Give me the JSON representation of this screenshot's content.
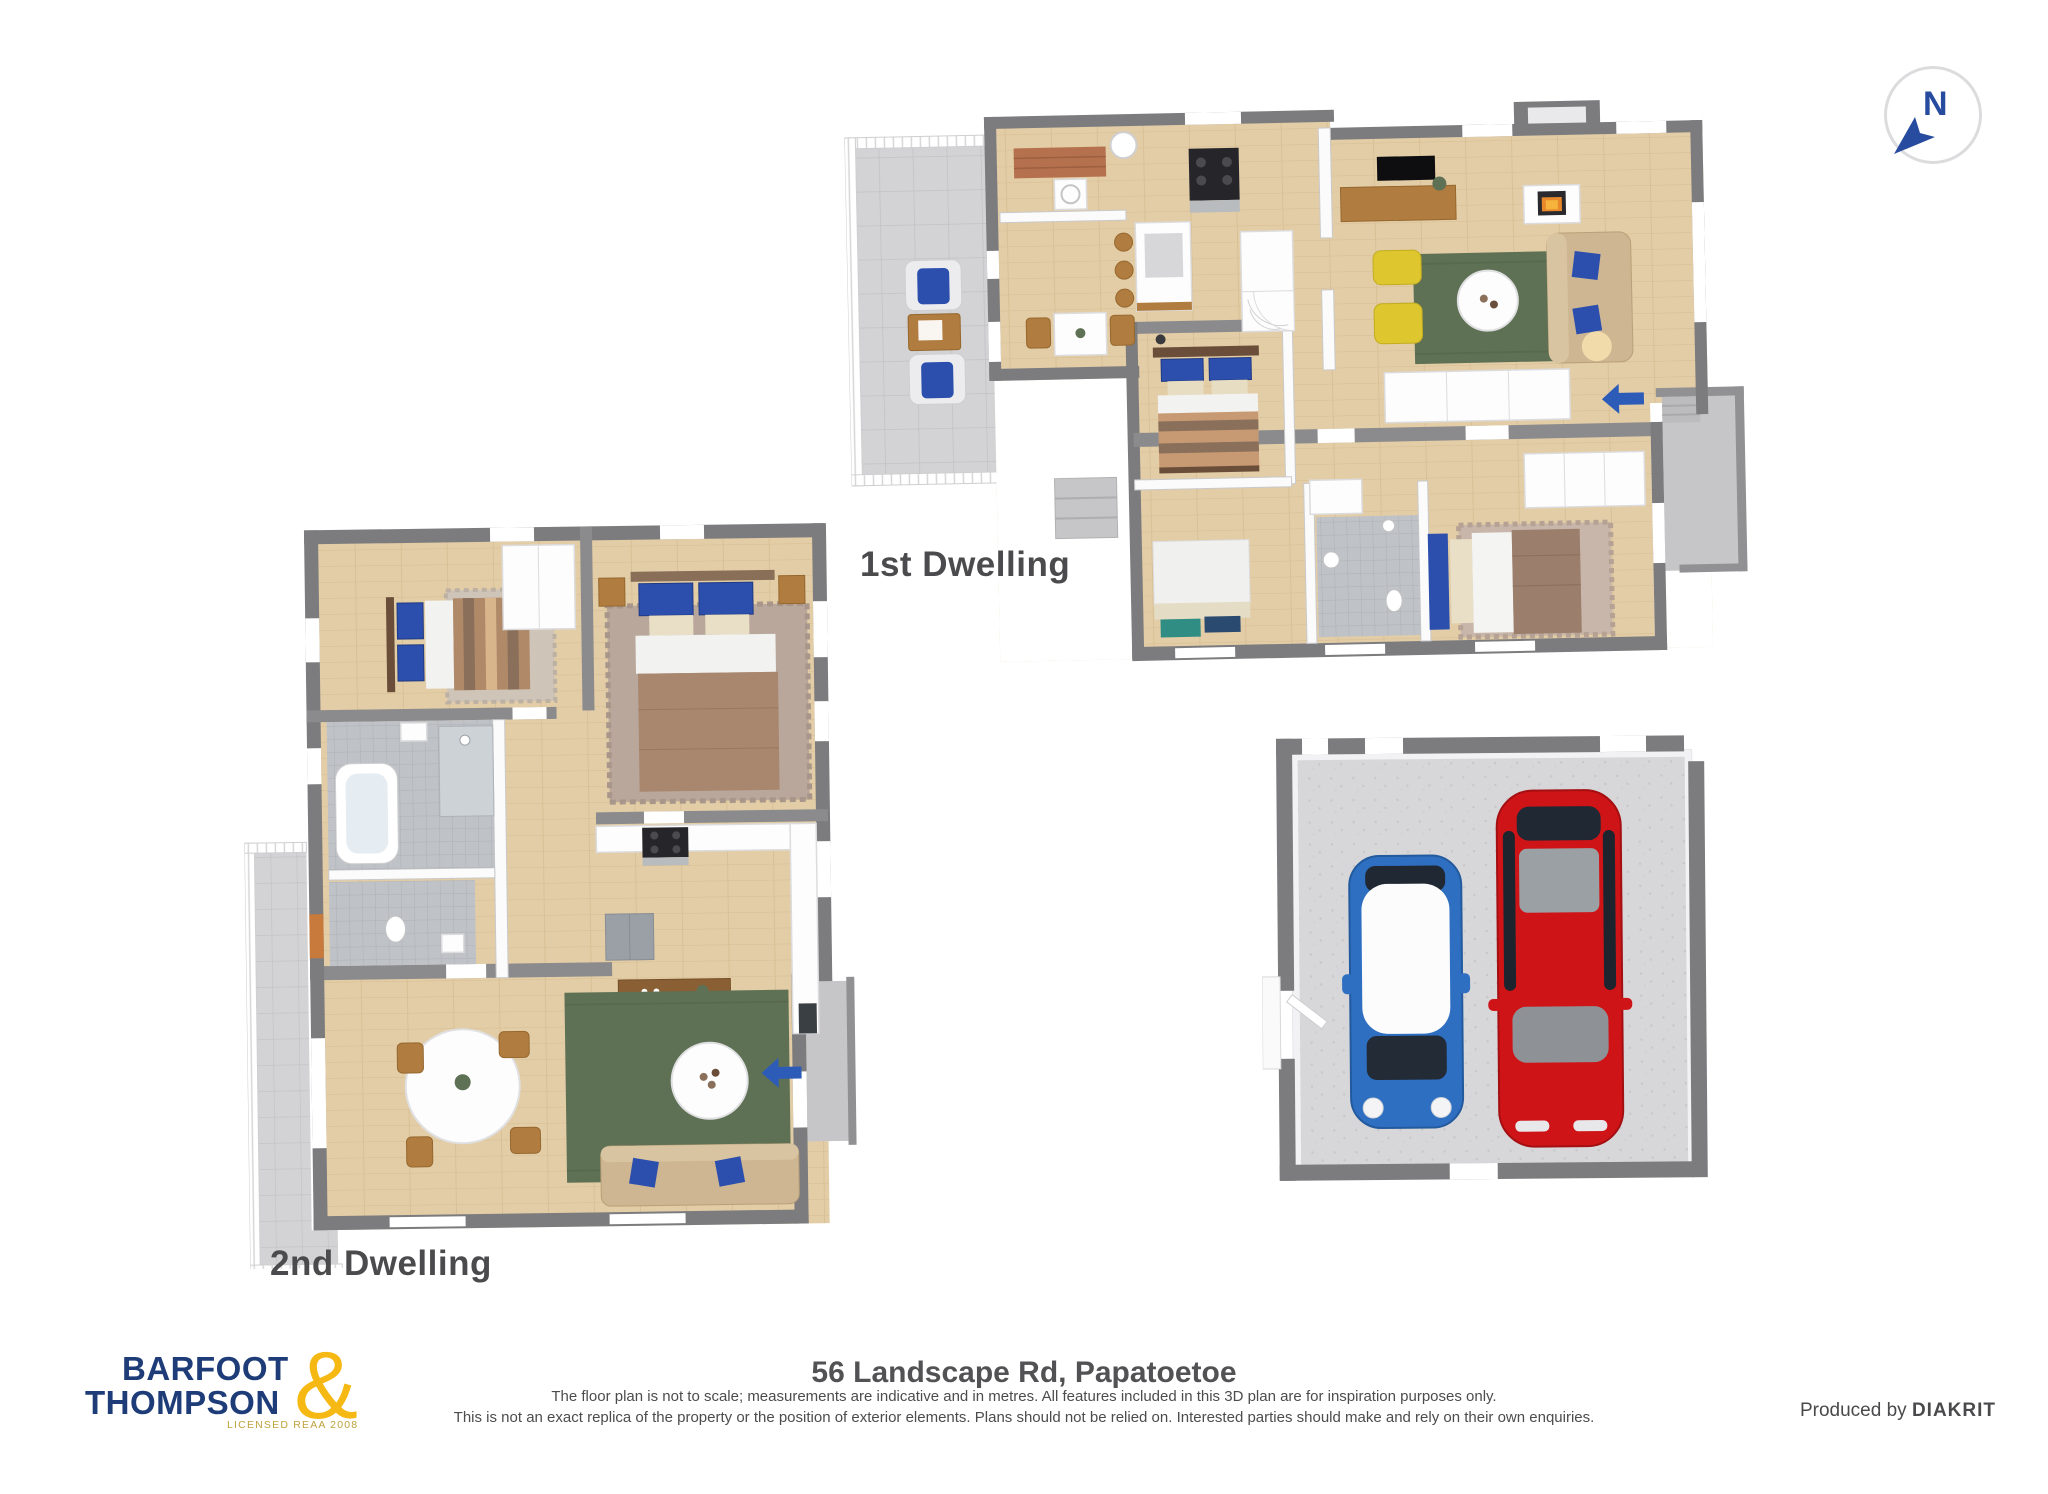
{
  "title_labels": {
    "first_dwelling": "1st Dwelling",
    "second_dwelling": "2nd Dwelling"
  },
  "compass": {
    "label": "N"
  },
  "footer": {
    "logo": {
      "line1": "BARFOOT",
      "line2": "THOMPSON",
      "ampersand": "&",
      "tagline": "LICENSED REAA 2008"
    },
    "address": "56 Landscape Rd, Papatoetoe",
    "disclaimer_line1": "The floor plan is not to scale; measurements are indicative and in metres. All features included in this 3D plan are for inspiration purposes only.",
    "disclaimer_line2": "This is not an exact replica of the property or the position of exterior elements. Plans should not be relied on. Interested parties should make and rely on their own enquiries.",
    "produced_by_prefix": "Produced by ",
    "producer": "DIAKRIT"
  },
  "colors": {
    "brand_navy": "#1d3c78",
    "brand_gold": "#f6b812",
    "compass_blue": "#274b9f",
    "arrow_blue": "#2d5cb8",
    "label_gray": "#4b4b4d",
    "wall_dark": "#7c7c7e",
    "wood_floor": "#e3cda6",
    "deck_gray": "#d3d3d5",
    "porch_gray": "#c6c6c8",
    "rug_green": "#5f7155",
    "sofa_tan": "#cdb691",
    "chair_yellow": "#ddc62e",
    "pillow_blue": "#2c4fae",
    "duvet_brown": "#a8876e",
    "wood_furniture": "#b07c3f",
    "car_blue": "#2e6fc2",
    "car_red": "#cf1418",
    "garage_floor": "#d7d7d9"
  }
}
